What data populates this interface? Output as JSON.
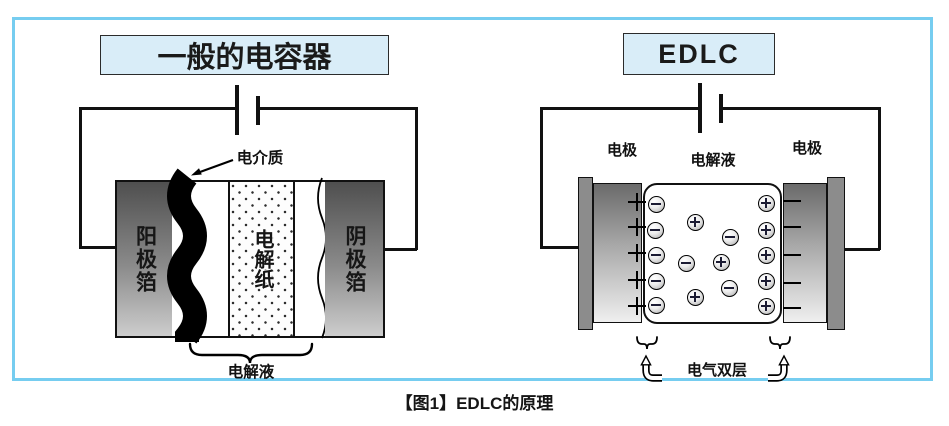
{
  "caption": "【图1】EDLC的原理",
  "left_diagram": {
    "title": "一般的电容器",
    "dielectric_label": "电介质",
    "anode_label": "阳极箔",
    "paper_label": "电解纸",
    "cathode_label": "阴极箔",
    "electrolyte_label": "电解液"
  },
  "right_diagram": {
    "title": "EDLC",
    "electrode_left_label": "电极",
    "electrolyte_label": "电解液",
    "electrode_right_label": "电极",
    "double_layer_label": "电气双层",
    "electrode_plus_rows": [
      202,
      227,
      253,
      280,
      306
    ],
    "electrode_minus_rows": [
      201,
      227,
      255,
      283,
      308
    ],
    "ions": [
      {
        "x": 656,
        "y": 204,
        "sign": "minus"
      },
      {
        "x": 655,
        "y": 230,
        "sign": "minus"
      },
      {
        "x": 656,
        "y": 255,
        "sign": "minus"
      },
      {
        "x": 656,
        "y": 281,
        "sign": "minus"
      },
      {
        "x": 656,
        "y": 305,
        "sign": "minus"
      },
      {
        "x": 766,
        "y": 203,
        "sign": "plus"
      },
      {
        "x": 766,
        "y": 230,
        "sign": "plus"
      },
      {
        "x": 766,
        "y": 255,
        "sign": "plus"
      },
      {
        "x": 766,
        "y": 281,
        "sign": "plus"
      },
      {
        "x": 766,
        "y": 306,
        "sign": "plus"
      },
      {
        "x": 695,
        "y": 222,
        "sign": "plus"
      },
      {
        "x": 730,
        "y": 237,
        "sign": "minus"
      },
      {
        "x": 686,
        "y": 263,
        "sign": "minus"
      },
      {
        "x": 721,
        "y": 262,
        "sign": "plus"
      },
      {
        "x": 729,
        "y": 288,
        "sign": "minus"
      },
      {
        "x": 695,
        "y": 297,
        "sign": "plus"
      }
    ]
  },
  "colors": {
    "frame_border": "#76CDF0",
    "title_box_bg": "#D9EDF8",
    "line": "#111111",
    "metal_dark": "#4f4f4f",
    "metal_light": "#cdcdcd",
    "collector": "#8c8c8c",
    "ion_line": "#1b1b33"
  }
}
